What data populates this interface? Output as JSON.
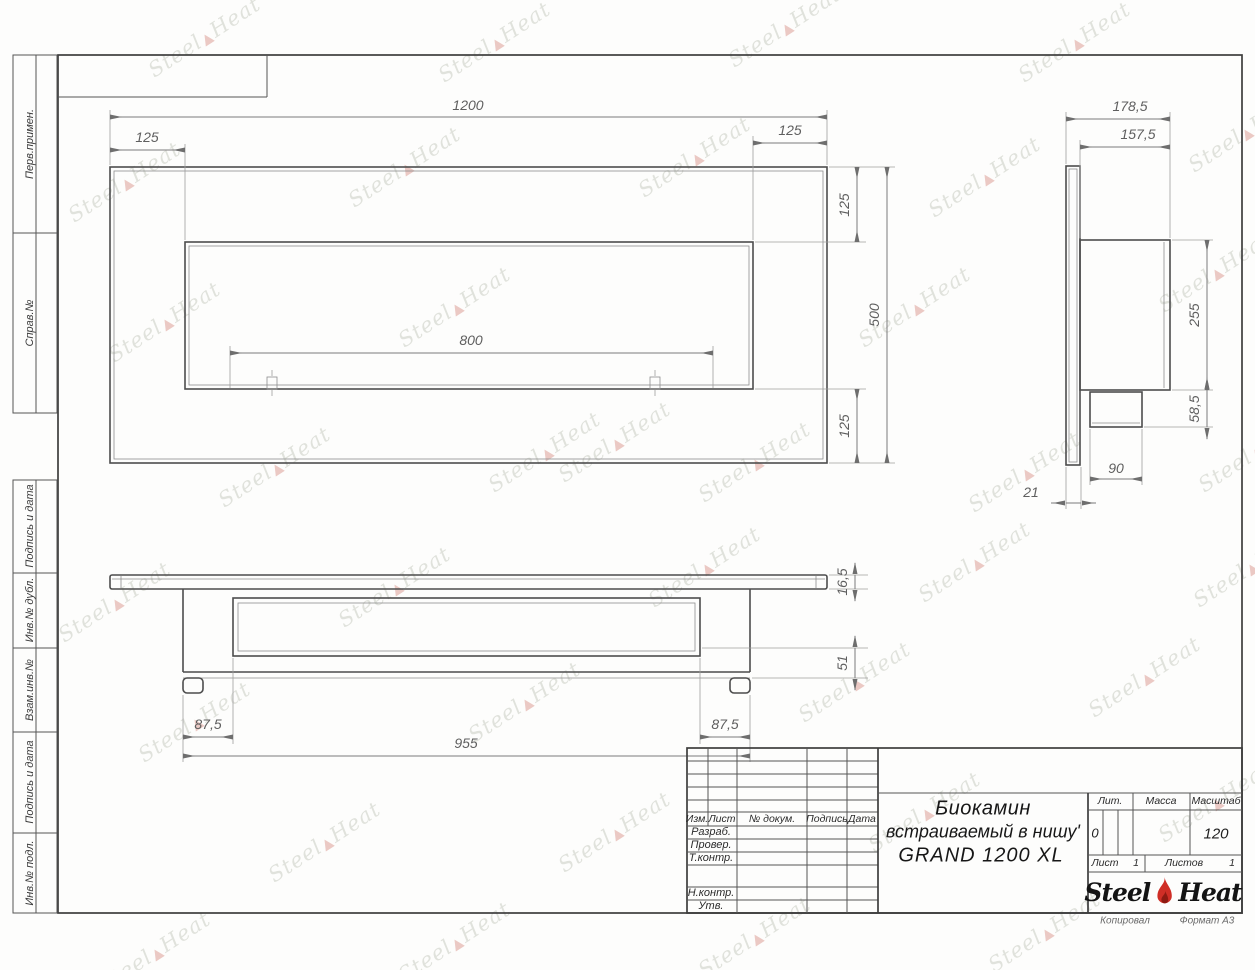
{
  "strip": {
    "labels": [
      "Перв.примен.",
      "Справ.№",
      "Подпись и дата",
      "Инв.№ дубл.",
      "Взам.инв.№",
      "Подпись и дата",
      "Инв.№ подл."
    ]
  },
  "drawing": {
    "dims": {
      "front": {
        "total": "1200",
        "margin_left": "125",
        "margin_right": "125",
        "opening": "800",
        "top": "125",
        "height": "500",
        "bottom": "125"
      },
      "side": {
        "total_depth": "178,5",
        "body_depth": "157,5",
        "body_height": "255",
        "box_height": "58,5",
        "box_width": "90",
        "panel_thickness": "21"
      },
      "bottom": {
        "plate_thickness": "16,5",
        "tray_depth": "51",
        "offset_left": "87,5",
        "offset_right": "87,5",
        "niche_width": "955"
      }
    }
  },
  "title_block": {
    "header": {
      "izm": "Изм.",
      "list": "Лист",
      "dokum": "№ докум.",
      "podpis": "Подпись",
      "data": "Дата"
    },
    "staff": {
      "razrab": "Разраб.",
      "prover": "Провер.",
      "tkontr": "Т.контр.",
      "nkontr": "Н.контр.",
      "utv": "Утв."
    },
    "title_line1": "Биокамин",
    "title_line2": "встраиваемый в нишу'",
    "title_line3": "GRAND 1200 XL",
    "lit_label": "Лит.",
    "lit_value": "0",
    "mass_label": "Масса",
    "scale_label": "Масштаб",
    "scale_value": "120",
    "sheet_label": "Лист",
    "sheet_value": "1",
    "sheets_label": "Листов",
    "sheets_value": "1",
    "logo_steel": "Steel",
    "logo_heat": "Heat"
  },
  "footer": {
    "left": "Копировал",
    "right": "Формат А3"
  },
  "watermark": {
    "steel": "Steel",
    "heat": "Heat",
    "flame_glyph": "▲"
  },
  "colors": {
    "outline": "#4d4d4d",
    "dim_line": "#7b7b7b",
    "accent_flame": "#cf2e26",
    "accent_flame_dark": "#8e1a12"
  }
}
